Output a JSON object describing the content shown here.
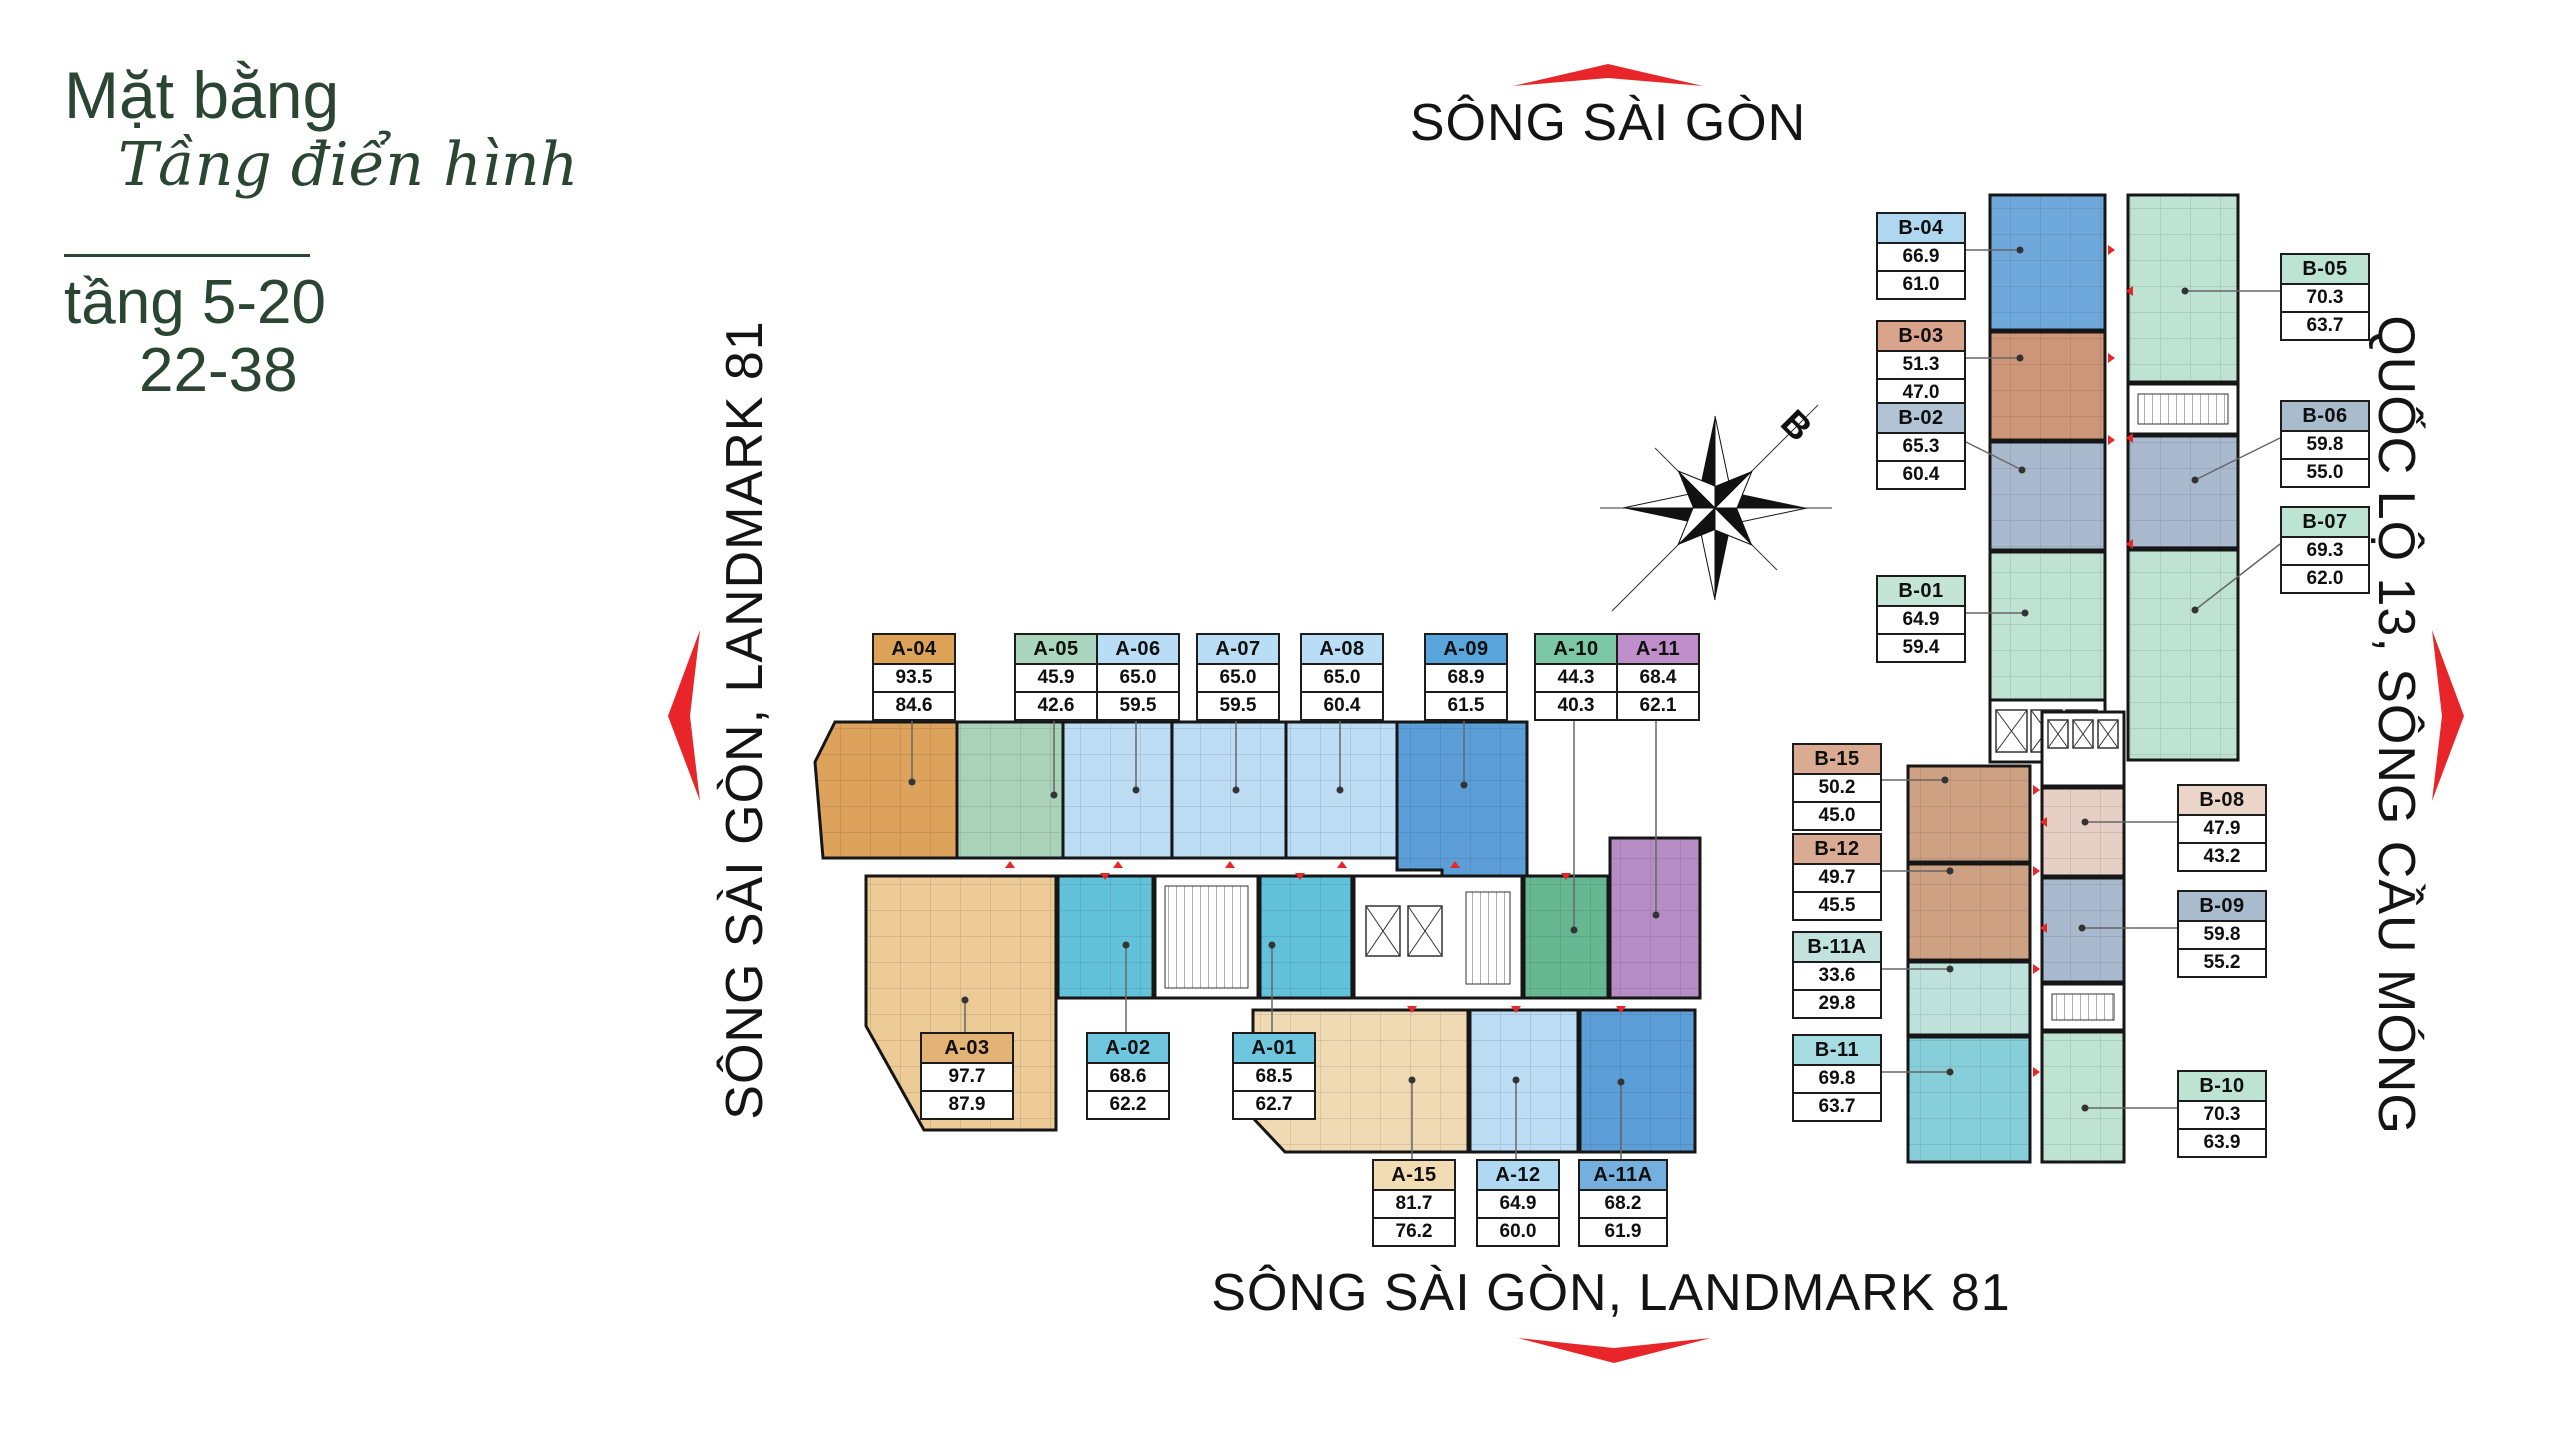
{
  "title": {
    "heading": "Mặt bằng",
    "subheading": "Tầng điển hình",
    "floors_line1": "tầng 5-20",
    "floors_line2": "22-38"
  },
  "directions": {
    "top": "SÔNG SÀI GÒN",
    "left": "SÔNG SÀI GÒN, LANDMARK 81",
    "right": "QUỐC LỘ 13, SÔNG CẦU MÓNG",
    "bottom": "SÔNG SÀI GÒN, LANDMARK 81"
  },
  "compass": {
    "label": "B"
  },
  "colors": {
    "accent_green": "#2A4633",
    "arrow_red": "#E8262A",
    "wall": "#161616"
  },
  "units": [
    {
      "id": "A-04",
      "name": "A-04",
      "gross": "93.5",
      "net": "84.6",
      "fill": "#DDA35C",
      "header": "#DCA257"
    },
    {
      "id": "A-05",
      "name": "A-05",
      "gross": "45.9",
      "net": "42.6",
      "fill": "#A9D2B9",
      "header": "#A9D6BD"
    },
    {
      "id": "A-06",
      "name": "A-06",
      "gross": "65.0",
      "net": "59.5",
      "fill": "#BCDDF3",
      "header": "#B8DDF4"
    },
    {
      "id": "A-07",
      "name": "A-07",
      "gross": "65.0",
      "net": "59.5",
      "fill": "#BCDDF3",
      "header": "#B8DDF4"
    },
    {
      "id": "A-08",
      "name": "A-08",
      "gross": "65.0",
      "net": "60.4",
      "fill": "#BCDDF3",
      "header": "#B8DDF4"
    },
    {
      "id": "A-09",
      "name": "A-09",
      "gross": "68.9",
      "net": "61.5",
      "fill": "#5C9FD8",
      "header": "#5AA4DC"
    },
    {
      "id": "A-10",
      "name": "A-10",
      "gross": "44.3",
      "net": "40.3",
      "fill": "#66B893",
      "header": "#7CC8A6"
    },
    {
      "id": "A-11",
      "name": "A-11",
      "gross": "68.4",
      "net": "62.1",
      "fill": "#B68CC4",
      "header": "#C08FCB"
    },
    {
      "id": "A-03",
      "name": "A-03",
      "gross": "97.7",
      "net": "87.9",
      "fill": "#ECCB96",
      "header": "#E2B277"
    },
    {
      "id": "A-02",
      "name": "A-02",
      "gross": "68.6",
      "net": "62.2",
      "fill": "#62C2DA",
      "header": "#6EC6DF"
    },
    {
      "id": "A-01",
      "name": "A-01",
      "gross": "68.5",
      "net": "62.7",
      "fill": "#62C2DA",
      "header": "#6EC6DF"
    },
    {
      "id": "A-15",
      "name": "A-15",
      "gross": "81.7",
      "net": "76.2",
      "fill": "#F0DAB3",
      "header": "#F2DCB4"
    },
    {
      "id": "A-12",
      "name": "A-12",
      "gross": "64.9",
      "net": "60.0",
      "fill": "#BCDDF3",
      "header": "#AFD8F2"
    },
    {
      "id": "A-11A",
      "name": "A-11A",
      "gross": "68.2",
      "net": "61.9",
      "fill": "#5C9FD8",
      "header": "#74AFDE"
    },
    {
      "id": "B-04",
      "name": "B-04",
      "gross": "66.9",
      "net": "61.0",
      "fill": "#6FA9DC",
      "header": "#AFD8F0"
    },
    {
      "id": "B-03",
      "name": "B-03",
      "gross": "51.3",
      "net": "47.0",
      "fill": "#CE9678",
      "header": "#D9A48C"
    },
    {
      "id": "B-02",
      "name": "B-02",
      "gross": "65.3",
      "net": "60.4",
      "fill": "#A9BACE",
      "header": "#B3C3D6"
    },
    {
      "id": "B-01",
      "name": "B-01",
      "gross": "64.9",
      "net": "59.4",
      "fill": "#BFE3D2",
      "header": "#C4E5D6"
    },
    {
      "id": "B-05",
      "name": "B-05",
      "gross": "70.3",
      "net": "63.7",
      "fill": "#BFE3D2",
      "header": "#BDE3D2"
    },
    {
      "id": "B-06",
      "name": "B-06",
      "gross": "59.8",
      "net": "55.0",
      "fill": "#A9BACE",
      "header": "#A9BCCE"
    },
    {
      "id": "B-07",
      "name": "B-07",
      "gross": "69.3",
      "net": "62.0",
      "fill": "#BFE3D2",
      "header": "#BDE3D2"
    },
    {
      "id": "B-15",
      "name": "B-15",
      "gross": "50.2",
      "net": "45.0",
      "fill": "#CFA183",
      "header": "#D9AB92"
    },
    {
      "id": "B-12",
      "name": "B-12",
      "gross": "49.7",
      "net": "45.5",
      "fill": "#CFA183",
      "header": "#D9AB92"
    },
    {
      "id": "B-11A",
      "name": "B-11A",
      "gross": "33.6",
      "net": "29.8",
      "fill": "#BFE1DC",
      "header": "#C2E2DE"
    },
    {
      "id": "B-11",
      "name": "B-11",
      "gross": "69.8",
      "net": "63.7",
      "fill": "#86CFD8",
      "header": "#A5DDE2"
    },
    {
      "id": "B-08",
      "name": "B-08",
      "gross": "47.9",
      "net": "43.2",
      "fill": "#E6D0C5",
      "header": "#EBD5C9"
    },
    {
      "id": "B-09",
      "name": "B-09",
      "gross": "59.8",
      "net": "55.2",
      "fill": "#A9BACE",
      "header": "#A9BCCE"
    },
    {
      "id": "B-10",
      "name": "B-10",
      "gross": "70.3",
      "net": "63.9",
      "fill": "#BFE3D2",
      "header": "#BDE3D2"
    }
  ]
}
